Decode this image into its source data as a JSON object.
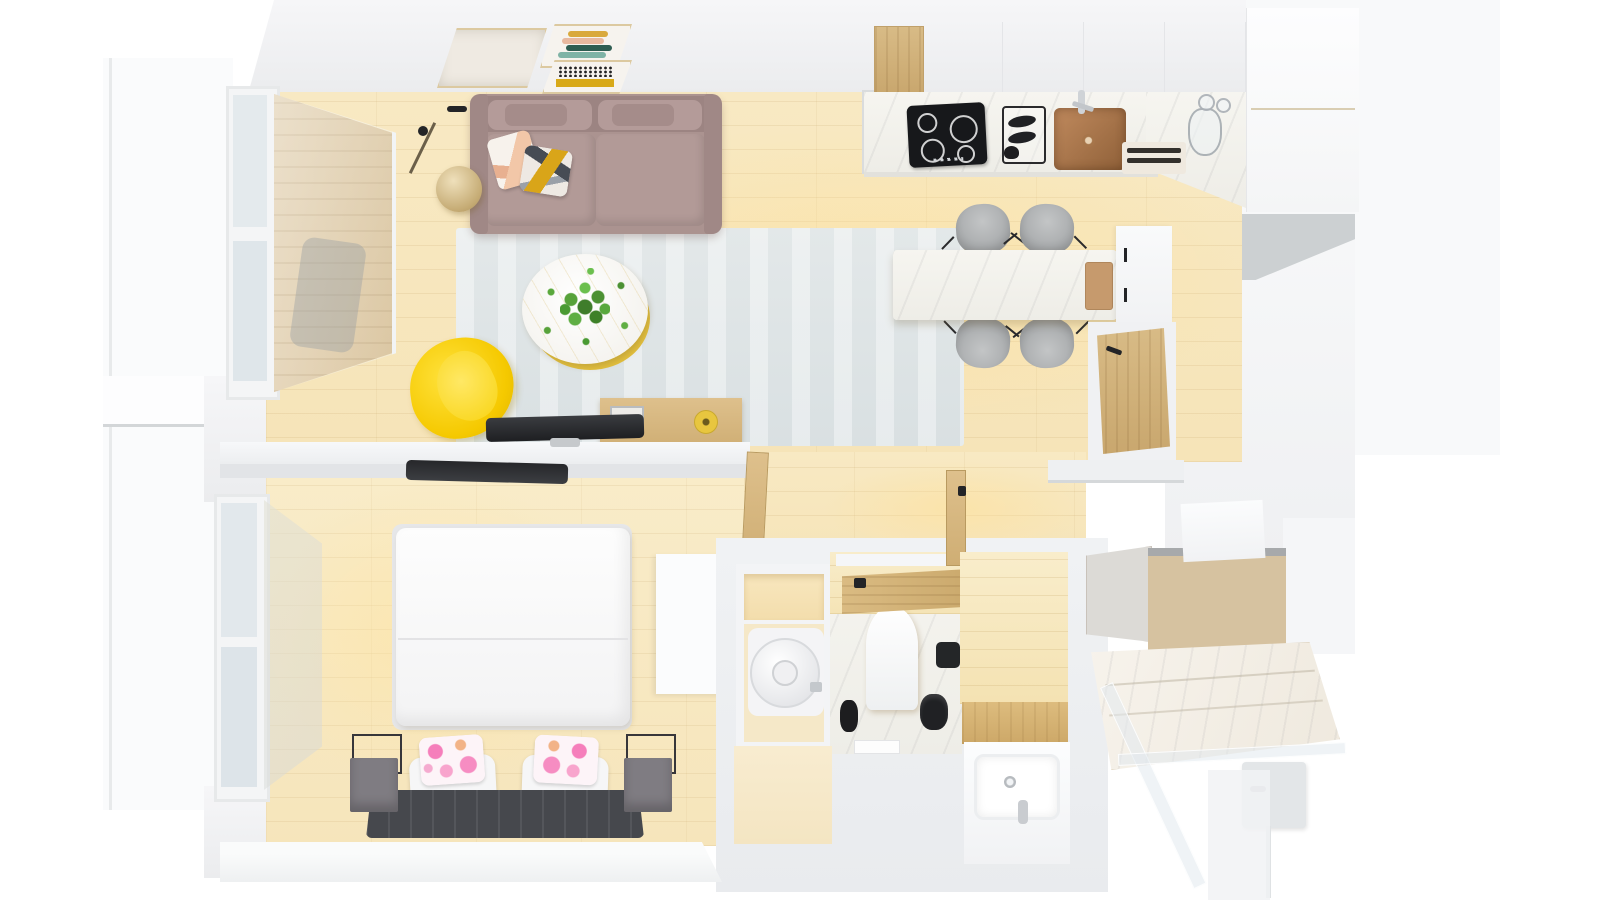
{
  "scene": {
    "type": "3d-floor-plan-top-view",
    "description": "Top-down 3D render of a one-bedroom apartment with open living/kitchen area, bedroom, bathroom, WC, walk-in shower and balcony",
    "view": "bird's-eye perspective render, no visible text or UI controls",
    "background": "#ffffff"
  },
  "palette": {
    "floor_wood": "#f8e8c2",
    "wall_white": "#f1f2f4",
    "wall_shadow": "#ccd0d2",
    "rug_grey": "#e0e6e7",
    "sofa_mauve": "#ab9390",
    "armchair_yellow": "#ffd60a",
    "marble_white": "#f4f3ee",
    "wood_oak": "#d3b177",
    "cabinet_laminate": "#d6c2a0",
    "dark_furniture": "#46484d",
    "chair_grey": "#a8abad",
    "sink_copper": "#b5825a",
    "pillow_pink": "#f06ab0",
    "plant_green": "#4f9c33",
    "cooktop_black": "#17181b"
  },
  "rooms": [
    {
      "id": "living-room",
      "label": "Living room",
      "furniture": [
        "mauve fabric sofa with two back cushions",
        "pink abstract throw pillow",
        "yellow-grey abstract throw pillow",
        "brass floor lamp",
        "round white coffee table with gold rim",
        "green potted plant",
        "pale grey-blue rug",
        "yellow accent armchair",
        "oak media console",
        "glass photo frame",
        "yellow candle",
        "flat-screen tv on half wall",
        "three framed wall artworks"
      ]
    },
    {
      "id": "kitchen",
      "label": "Kitchen",
      "furniture": [
        "oak upper cabinet",
        "white upper cabinets",
        "white marble counter",
        "black induction cooktop with four burners",
        "black dish rack with plates",
        "copper basin sink",
        "chrome faucet",
        "wooden cutting boards",
        "glass jug and glasses",
        "tall white cabinet column"
      ]
    },
    {
      "id": "dining-area",
      "label": "Dining area",
      "furniture": [
        "white marble dining table",
        "four grey upholstered chairs with black legs",
        "wooden serving tray"
      ]
    },
    {
      "id": "entry",
      "label": "Entry",
      "furniture": [
        "oak entrance door with black lever handle",
        "white sill cabinet",
        "tall white cabinet with black handles"
      ]
    },
    {
      "id": "bedroom",
      "label": "Bedroom",
      "furniture": [
        "double bed with white duvet",
        "two white pillows",
        "two pink floral pillows",
        "dark grey channel-tufted headboard",
        "two grey metal-frame nightstands",
        "wall-mounted tv on half wall",
        "white wardrobe",
        "oak door",
        "balcony windows"
      ]
    },
    {
      "id": "bathroom",
      "label": "Bathroom",
      "furniture": [
        "white water-heater cylinder in niche",
        "storage niche shelf",
        "oak swing door with black handle",
        "white rectangular basin on oak bench",
        "chrome faucet",
        "soap dispenser"
      ]
    },
    {
      "id": "wc",
      "label": "WC",
      "furniture": [
        "wall-hung white toilet",
        "black toilet brush",
        "black waste bin",
        "black toilet-roll holder",
        "marble floor",
        "beige tiled walls"
      ]
    },
    {
      "id": "shower-room",
      "label": "Walk-in shower",
      "furniture": [
        "marble shower tray",
        "glass shower screens",
        "grey mixer panel with chrome valve",
        "oak storage cabinet with grey front",
        "white cabinet top"
      ]
    },
    {
      "id": "balcony",
      "label": "Balcony",
      "furniture": [
        "wood decking seen through glазing",
        "white railing ledge",
        "full-height window frames"
      ]
    }
  ]
}
